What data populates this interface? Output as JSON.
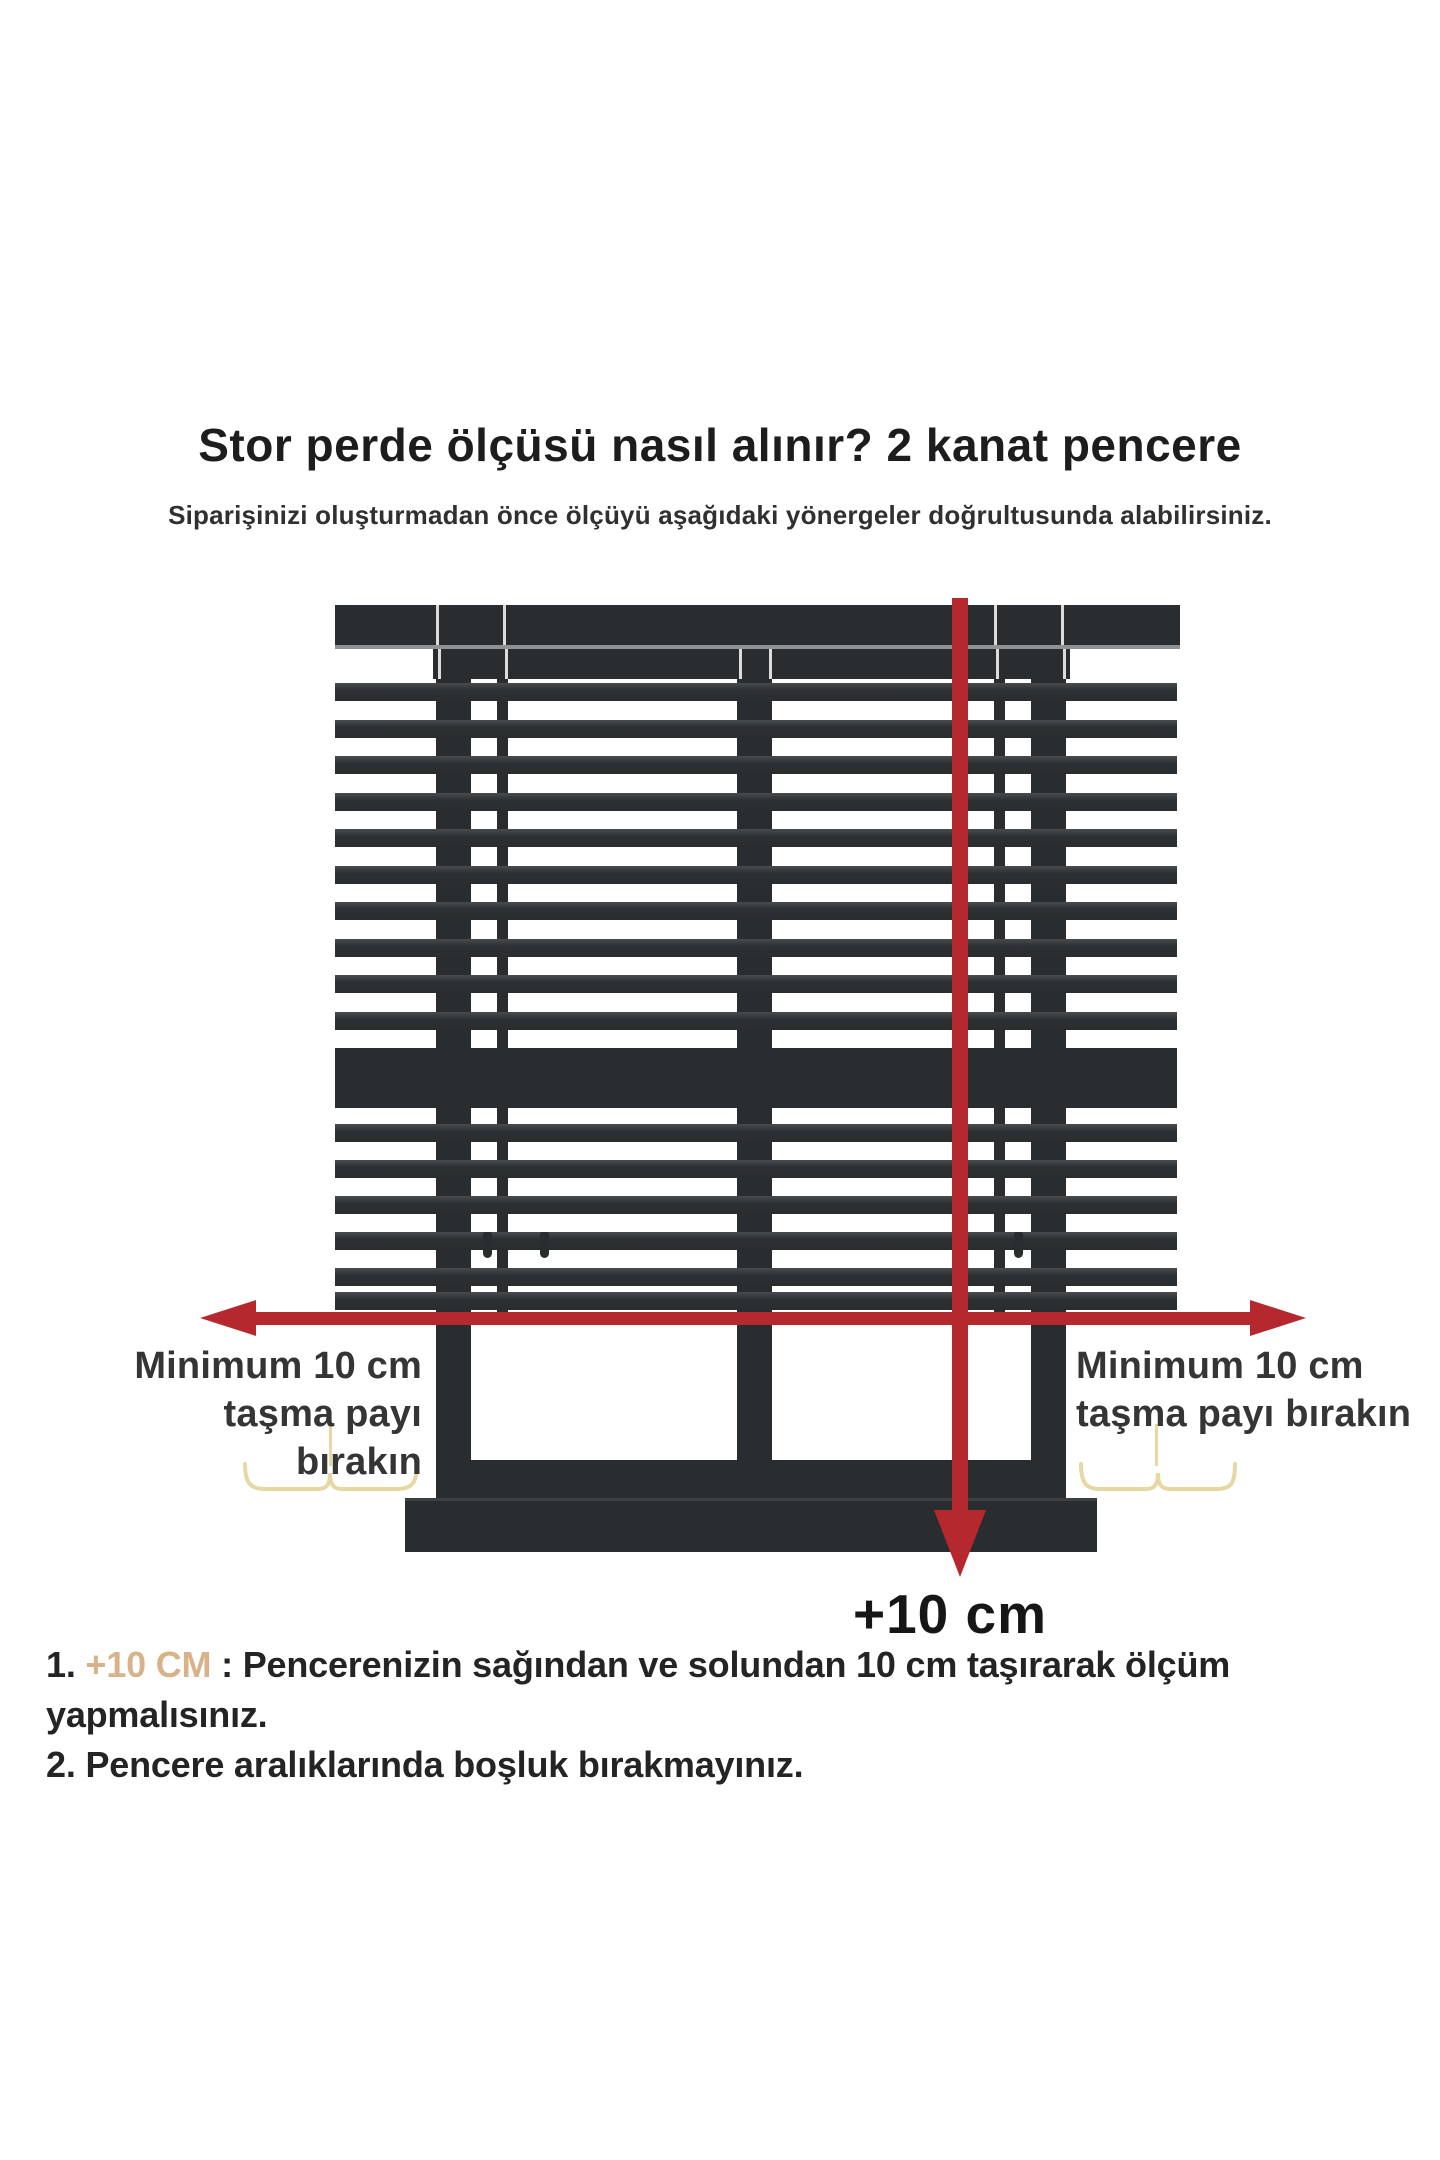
{
  "header": {
    "title": "Stor perde ölçüsü nasıl alınır? 2 kanat pencere",
    "subtitle": "Siparişinizi oluşturmadan önce ölçüyü aşağıdaki yönergeler doğrultusunda alabilirsiniz."
  },
  "labels": {
    "left": {
      "line1": "Minimum 10 cm",
      "line2": "taşma payı bırakın"
    },
    "right": {
      "line1": "Minimum 10 cm",
      "line2": "taşma payı bırakın"
    },
    "plus10": "+10 cm"
  },
  "notes": [
    {
      "number": "1.",
      "highlight": " +10 CM",
      "separator": " : ",
      "text": "Pencerenizin sağından ve solundan 10 cm taşırarak ölçüm yapmalısınız."
    },
    {
      "number": "2.",
      "highlight": "",
      "separator": " ",
      "text": "Pencere aralıklarında boşluk bırakmayınız."
    }
  ],
  "colors": {
    "blind-dark": "#2a2d2f",
    "arrow-red": "#b5292e",
    "brace-yellow": "#e7d7a2",
    "highlight-tan": "#d8b38a"
  },
  "blind": {
    "slats_upper_tops": [
      683,
      720,
      756,
      793,
      829,
      866,
      902,
      939,
      975,
      1012
    ],
    "slats_lower_tops": [
      1124,
      1160,
      1196,
      1232,
      1268,
      1292
    ],
    "valance_slits_x": [
      436,
      503,
      994,
      1061
    ],
    "tier2_slits_x": [
      438,
      505,
      739,
      769,
      996,
      1063
    ],
    "band_slits_x": [
      503,
      1000
    ],
    "rail_slits_x": [
      739,
      766
    ],
    "hooks": [
      {
        "x": 483,
        "y": 1232
      },
      {
        "x": 540,
        "y": 1232
      },
      {
        "x": 1014,
        "y": 1232
      }
    ]
  }
}
